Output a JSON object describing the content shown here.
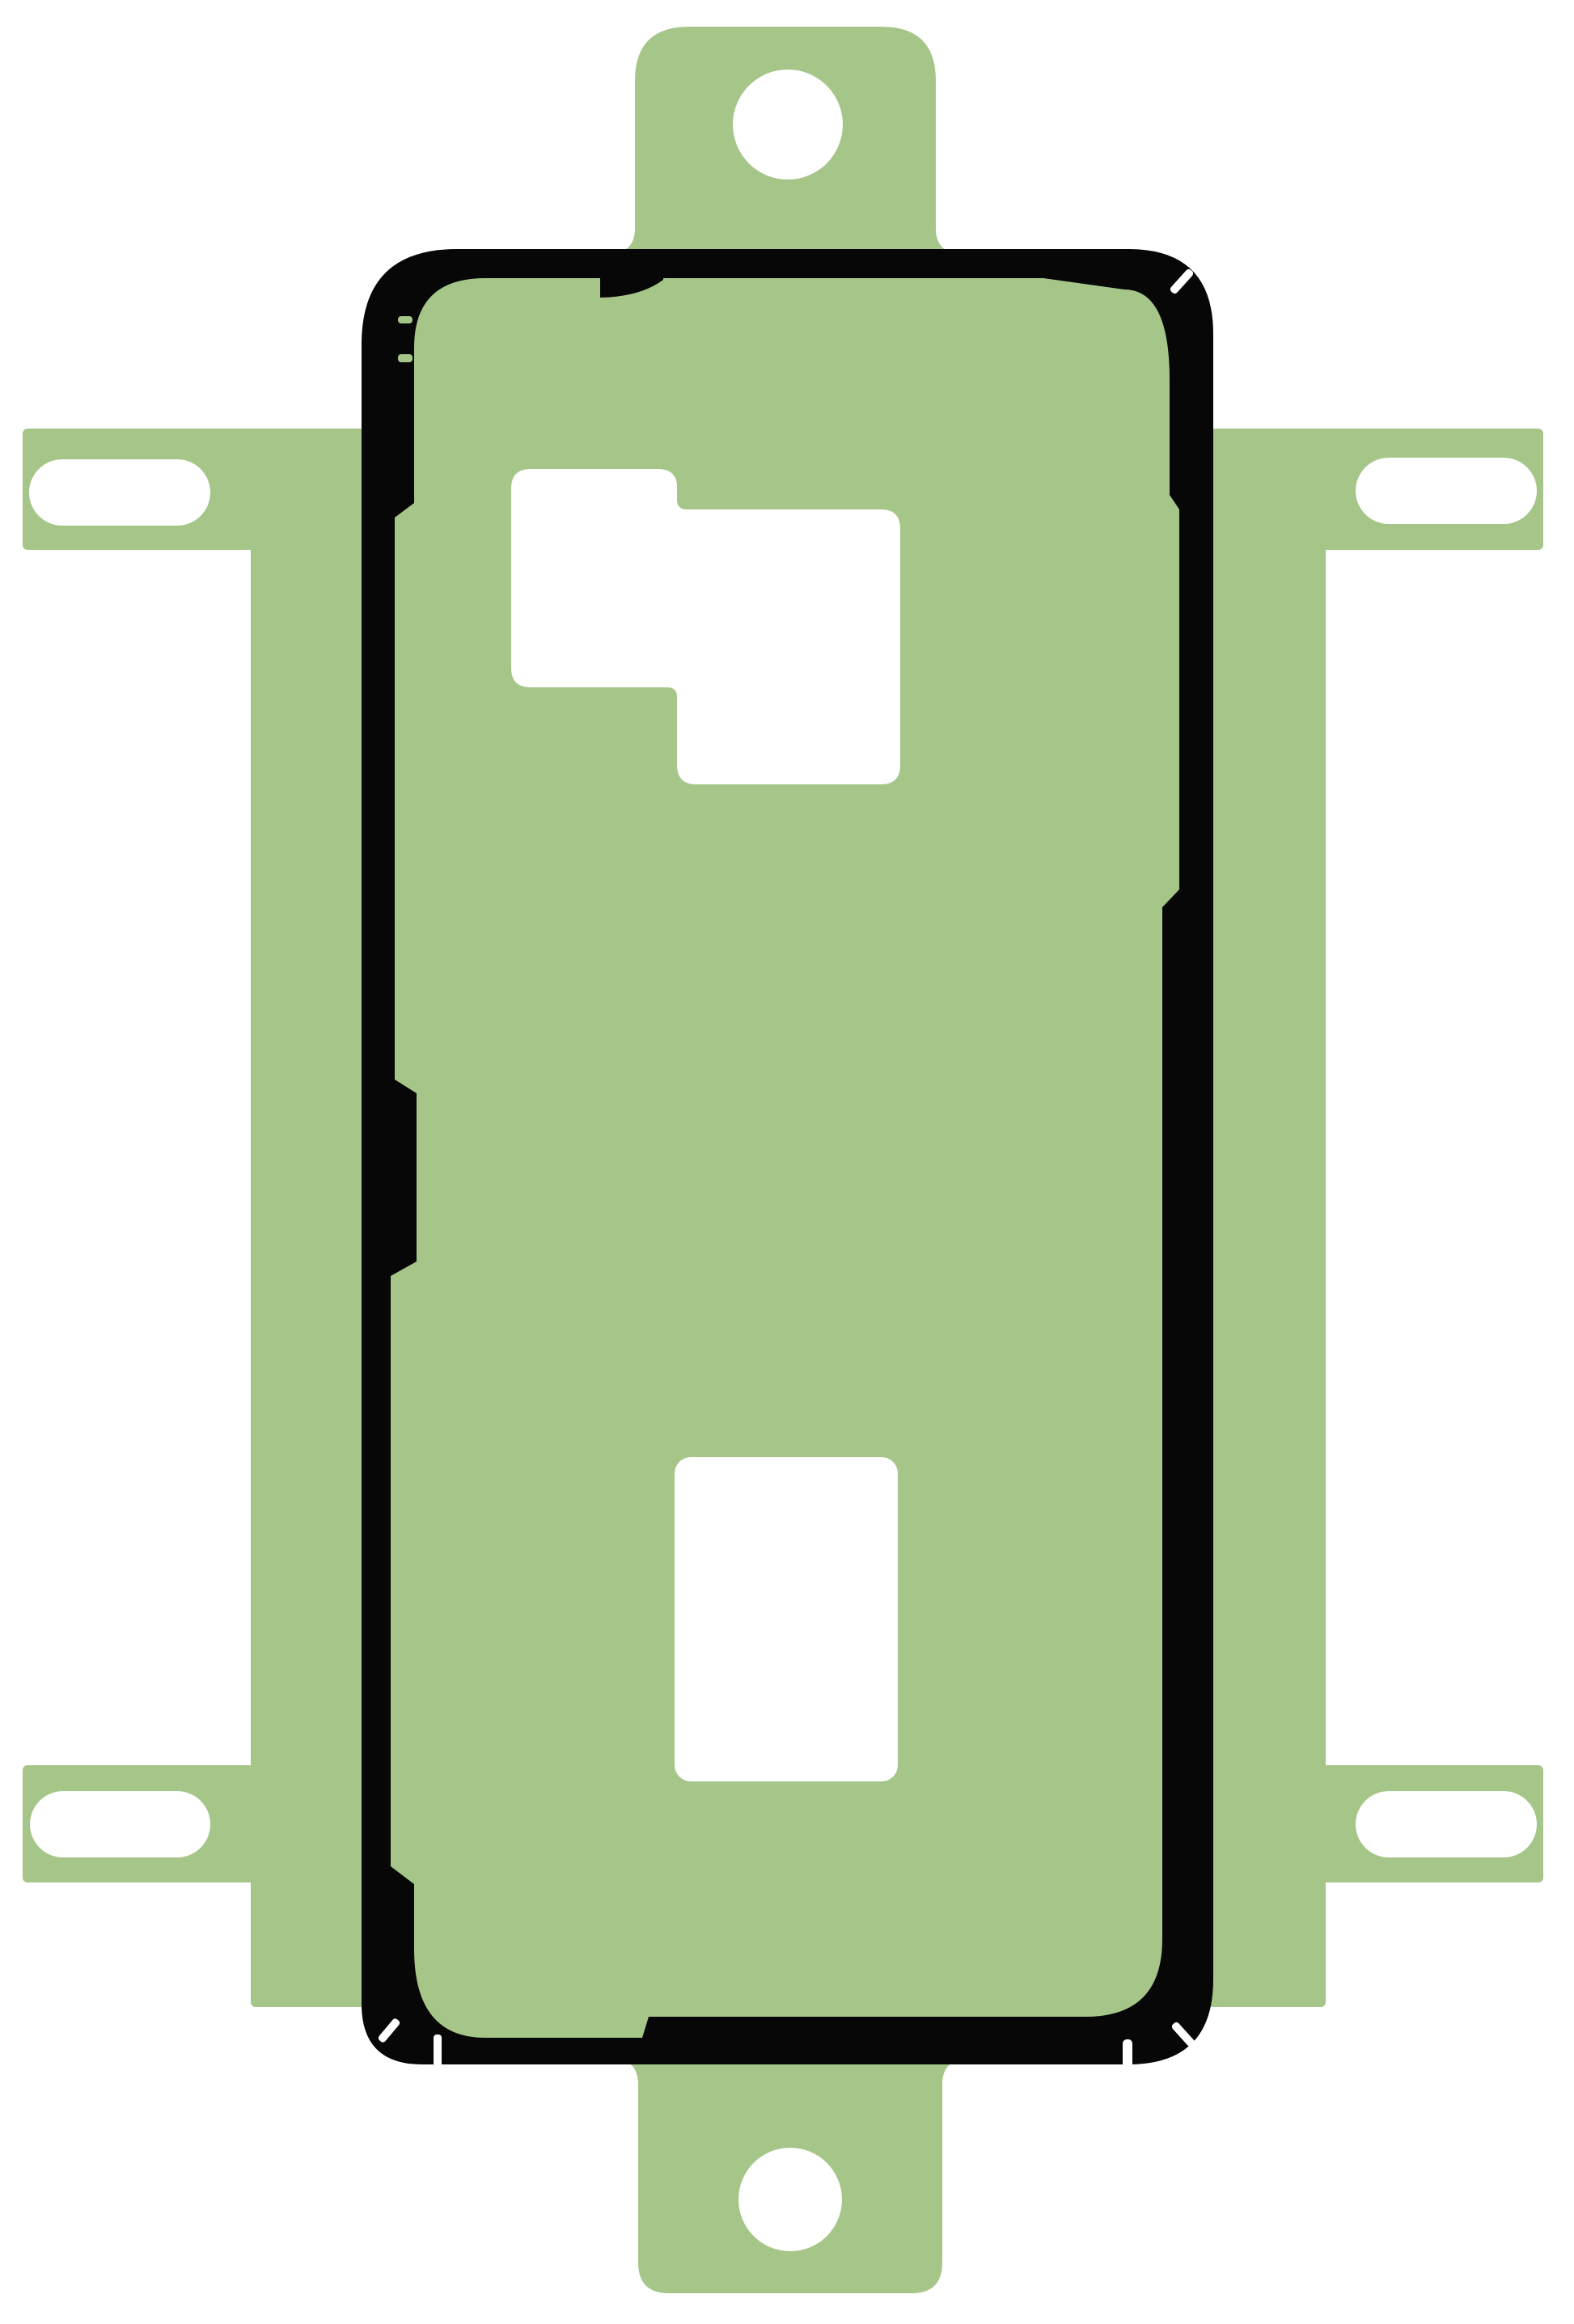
{
  "image": {
    "kind": "product-illustration",
    "subject": "smartphone back cover adhesive sticker sheet with liner tabs",
    "orientation": "portrait"
  },
  "colors": {
    "background": "#ffffff",
    "film": "#a5c688",
    "gasket": "#070707",
    "cutout": "#ffffff"
  },
  "parts": {
    "film": "green adhesive liner film",
    "gasket": "black phone-frame adhesive gasket outline",
    "top_tab": "top handling tab with round hole",
    "bottom_tab": "bottom handling tab with round hole",
    "left_rail": "left liner rail with two slotted holes",
    "right_rail": "right liner rail with two slotted holes",
    "camera_cutout": "L-shaped camera window cutout",
    "lower_cutout": "rectangular fingerprint window cutout",
    "notches": "die-cut registration notches on gasket"
  },
  "counts": {
    "round_holes": 2,
    "slot_holes": 4,
    "white_cutouts_inside_gasket": 2
  }
}
